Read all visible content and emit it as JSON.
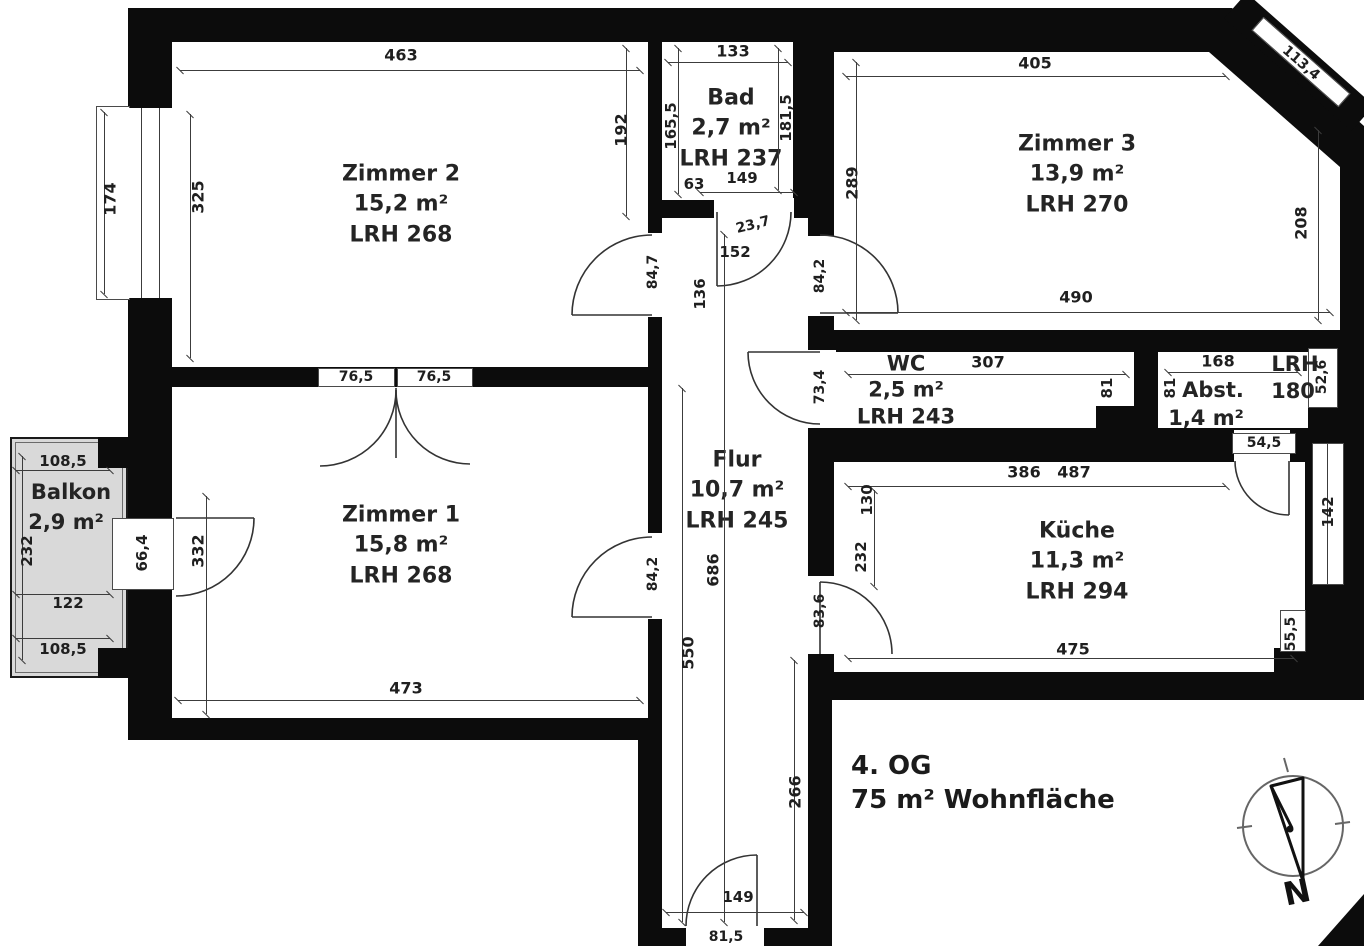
{
  "footer": {
    "floor": "4. OG",
    "total_area": "75 m² Wohnfläche"
  },
  "compass": {
    "north_label": "N"
  },
  "colors": {
    "wall": "#0c0c0c",
    "balcony": "#d9d9d9",
    "line": "#3c3c3c",
    "text": "#242424"
  },
  "rooms": {
    "zimmer2": {
      "name": "Zimmer 2",
      "area": "15,2 m²",
      "ceiling": "LRH 268"
    },
    "bad": {
      "name": "Bad",
      "area": "2,7 m²",
      "ceiling": "LRH 237"
    },
    "zimmer3": {
      "name": "Zimmer 3",
      "area": "13,9 m²",
      "ceiling": "LRH 270"
    },
    "wc": {
      "name": "WC",
      "area": "2,5 m²",
      "ceiling": "LRH 243"
    },
    "abst": {
      "name": "Abst.",
      "area": "1,4 m²",
      "ceiling_label": "LRH",
      "ceiling_value": "180"
    },
    "flur": {
      "name": "Flur",
      "area": "10,7 m²",
      "ceiling": "LRH 245"
    },
    "zimmer1": {
      "name": "Zimmer 1",
      "area": "15,8 m²",
      "ceiling": "LRH 268"
    },
    "kueche": {
      "name": "Küche",
      "area": "11,3 m²",
      "ceiling": "LRH 294"
    },
    "balkon": {
      "name": "Balkon",
      "area": "2,9 m²"
    }
  },
  "dimensions": [
    {
      "t": "463",
      "x": 401,
      "y": 55
    },
    {
      "t": "192",
      "x": 621,
      "y": 130,
      "r": -90
    },
    {
      "t": "325",
      "x": 198,
      "y": 197,
      "r": -90
    },
    {
      "t": "174",
      "x": 110,
      "y": 199,
      "r": -90
    },
    {
      "t": "84,7",
      "x": 653,
      "y": 272,
      "r": -90,
      "s": 14
    },
    {
      "t": "76,5",
      "x": 356,
      "y": 377,
      "s": 14
    },
    {
      "t": "76,5",
      "x": 434,
      "y": 377,
      "s": 14
    },
    {
      "t": "133",
      "x": 733,
      "y": 51
    },
    {
      "t": "165,5",
      "x": 671,
      "y": 126,
      "r": -90,
      "s": 15
    },
    {
      "t": "181,5",
      "x": 786,
      "y": 118,
      "r": -90,
      "s": 15
    },
    {
      "t": "63",
      "x": 694,
      "y": 184,
      "s": 15
    },
    {
      "t": "149",
      "x": 742,
      "y": 178,
      "s": 15
    },
    {
      "t": "23,7",
      "x": 753,
      "y": 225,
      "r": -14,
      "s": 14
    },
    {
      "t": "152",
      "x": 735,
      "y": 252,
      "s": 15
    },
    {
      "t": "136",
      "x": 700,
      "y": 294,
      "r": -90,
      "s": 15
    },
    {
      "t": "405",
      "x": 1035,
      "y": 63
    },
    {
      "t": "113,4",
      "x": 1301,
      "y": 63,
      "r": 41,
      "s": 14
    },
    {
      "t": "289",
      "x": 852,
      "y": 183,
      "r": -90
    },
    {
      "t": "208",
      "x": 1301,
      "y": 223,
      "r": -90
    },
    {
      "t": "490",
      "x": 1076,
      "y": 297
    },
    {
      "t": "84,2",
      "x": 820,
      "y": 276,
      "r": -90,
      "s": 14
    },
    {
      "t": "307",
      "x": 988,
      "y": 362
    },
    {
      "t": "81",
      "x": 1107,
      "y": 388,
      "r": -90,
      "s": 15
    },
    {
      "t": "73,4",
      "x": 820,
      "y": 387,
      "r": -90,
      "s": 14
    },
    {
      "t": "168",
      "x": 1218,
      "y": 361
    },
    {
      "t": "81",
      "x": 1170,
      "y": 388,
      "r": -90,
      "s": 15
    },
    {
      "t": "52,6",
      "x": 1322,
      "y": 377,
      "r": -90,
      "s": 14
    },
    {
      "t": "54,5",
      "x": 1264,
      "y": 443,
      "s": 14
    },
    {
      "t": "686",
      "x": 713,
      "y": 570,
      "r": -90
    },
    {
      "t": "550",
      "x": 688,
      "y": 653,
      "r": -90
    },
    {
      "t": "266",
      "x": 795,
      "y": 792,
      "r": -90
    },
    {
      "t": "149",
      "x": 738,
      "y": 897,
      "s": 15
    },
    {
      "t": "81,5",
      "x": 726,
      "y": 937,
      "s": 14
    },
    {
      "t": "473",
      "x": 406,
      "y": 688
    },
    {
      "t": "332",
      "x": 198,
      "y": 551,
      "r": -90
    },
    {
      "t": "84,2",
      "x": 653,
      "y": 574,
      "r": -90,
      "s": 14
    },
    {
      "t": "66,4",
      "x": 142,
      "y": 553,
      "r": -90,
      "s": 15
    },
    {
      "t": "108,5",
      "x": 63,
      "y": 461,
      "s": 15
    },
    {
      "t": "232",
      "x": 27,
      "y": 551,
      "r": -90,
      "s": 15
    },
    {
      "t": "122",
      "x": 68,
      "y": 603,
      "s": 15
    },
    {
      "t": "108,5",
      "x": 63,
      "y": 649,
      "s": 15
    },
    {
      "t": "386",
      "x": 1024,
      "y": 472
    },
    {
      "t": "487",
      "x": 1074,
      "y": 472
    },
    {
      "t": "130",
      "x": 867,
      "y": 500,
      "r": -90,
      "s": 15
    },
    {
      "t": "232",
      "x": 861,
      "y": 557,
      "r": -90,
      "s": 15
    },
    {
      "t": "142",
      "x": 1328,
      "y": 512,
      "r": -90,
      "s": 15
    },
    {
      "t": "475",
      "x": 1073,
      "y": 649
    },
    {
      "t": "55,5",
      "x": 1291,
      "y": 634,
      "r": -90,
      "s": 14
    },
    {
      "t": "83,6",
      "x": 820,
      "y": 611,
      "r": -90,
      "s": 14
    }
  ],
  "dim_lines": [
    [
      180,
      70,
      640,
      70
    ],
    [
      190,
      114,
      190,
      358
    ],
    [
      626,
      48,
      626,
      216
    ],
    [
      104,
      112,
      104,
      294
    ],
    [
      668,
      62,
      788,
      62
    ],
    [
      678,
      48,
      678,
      194
    ],
    [
      778,
      48,
      778,
      190
    ],
    [
      700,
      192,
      794,
      192
    ],
    [
      846,
      76,
      1226,
      76
    ],
    [
      856,
      62,
      856,
      320
    ],
    [
      1318,
      130,
      1318,
      320
    ],
    [
      846,
      312,
      1330,
      312
    ],
    [
      848,
      374,
      1126,
      374
    ],
    [
      1168,
      372,
      1298,
      372
    ],
    [
      682,
      388,
      682,
      922
    ],
    [
      724,
      234,
      724,
      922
    ],
    [
      794,
      660,
      794,
      920
    ],
    [
      666,
      912,
      804,
      912
    ],
    [
      178,
      700,
      640,
      700
    ],
    [
      206,
      496,
      206,
      714
    ],
    [
      22,
      456,
      22,
      660
    ],
    [
      16,
      470,
      110,
      470
    ],
    [
      16,
      594,
      110,
      594
    ],
    [
      16,
      638,
      110,
      638
    ],
    [
      848,
      486,
      1226,
      486
    ],
    [
      874,
      490,
      874,
      586
    ],
    [
      848,
      658,
      1294,
      658
    ]
  ]
}
